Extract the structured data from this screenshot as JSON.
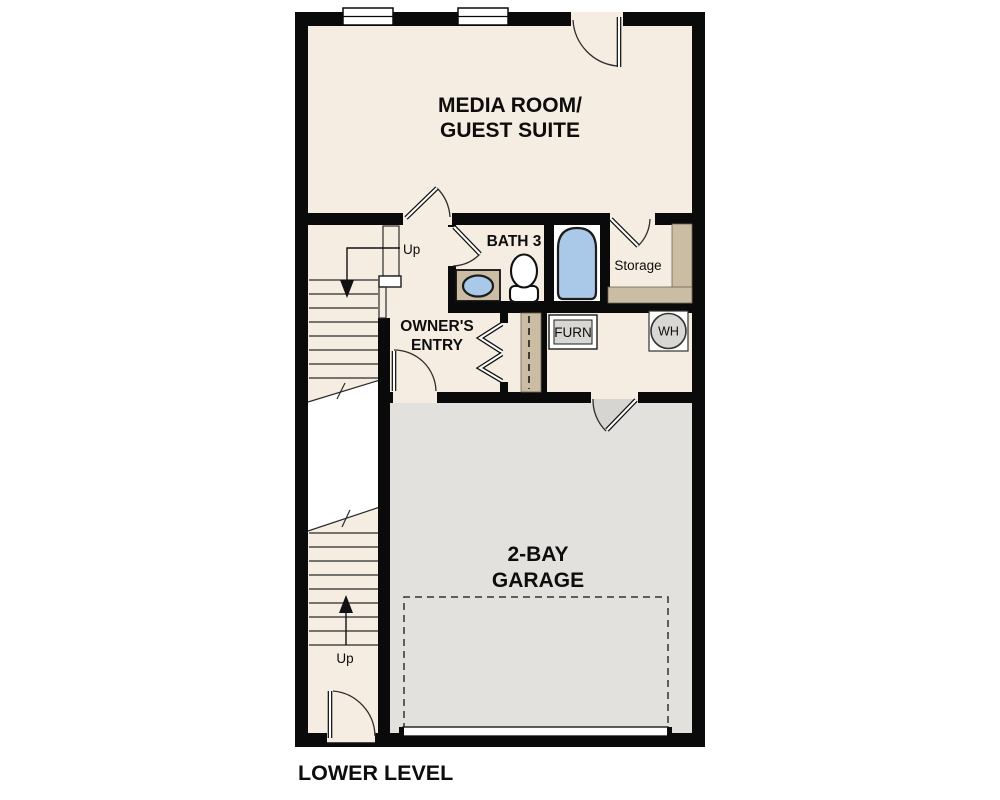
{
  "plan": {
    "title": "LOWER LEVEL",
    "rooms": {
      "media": {
        "line1": "MEDIA ROOM/",
        "line2": "GUEST SUITE"
      },
      "bath": {
        "name": "BATH 3"
      },
      "storage": {
        "name": "Storage"
      },
      "owners_entry": {
        "line1": "OWNER'S",
        "line2": "ENTRY"
      },
      "garage": {
        "line1": "2-BAY",
        "line2": "GARAGE"
      }
    },
    "equipment": {
      "furnace": "FURN",
      "water_heater": "WH"
    },
    "stairs": {
      "upper_direction": "Up",
      "lower_direction": "Up"
    },
    "colors": {
      "floor_beige": "#f5ede1",
      "garage_gray": "#e2e1dd",
      "shelf_tan": "#cabda3",
      "fixture_blue": "#aac9e8",
      "equipment_gray": "#d8d7d3",
      "wall_black": "#0a0a0a"
    }
  }
}
